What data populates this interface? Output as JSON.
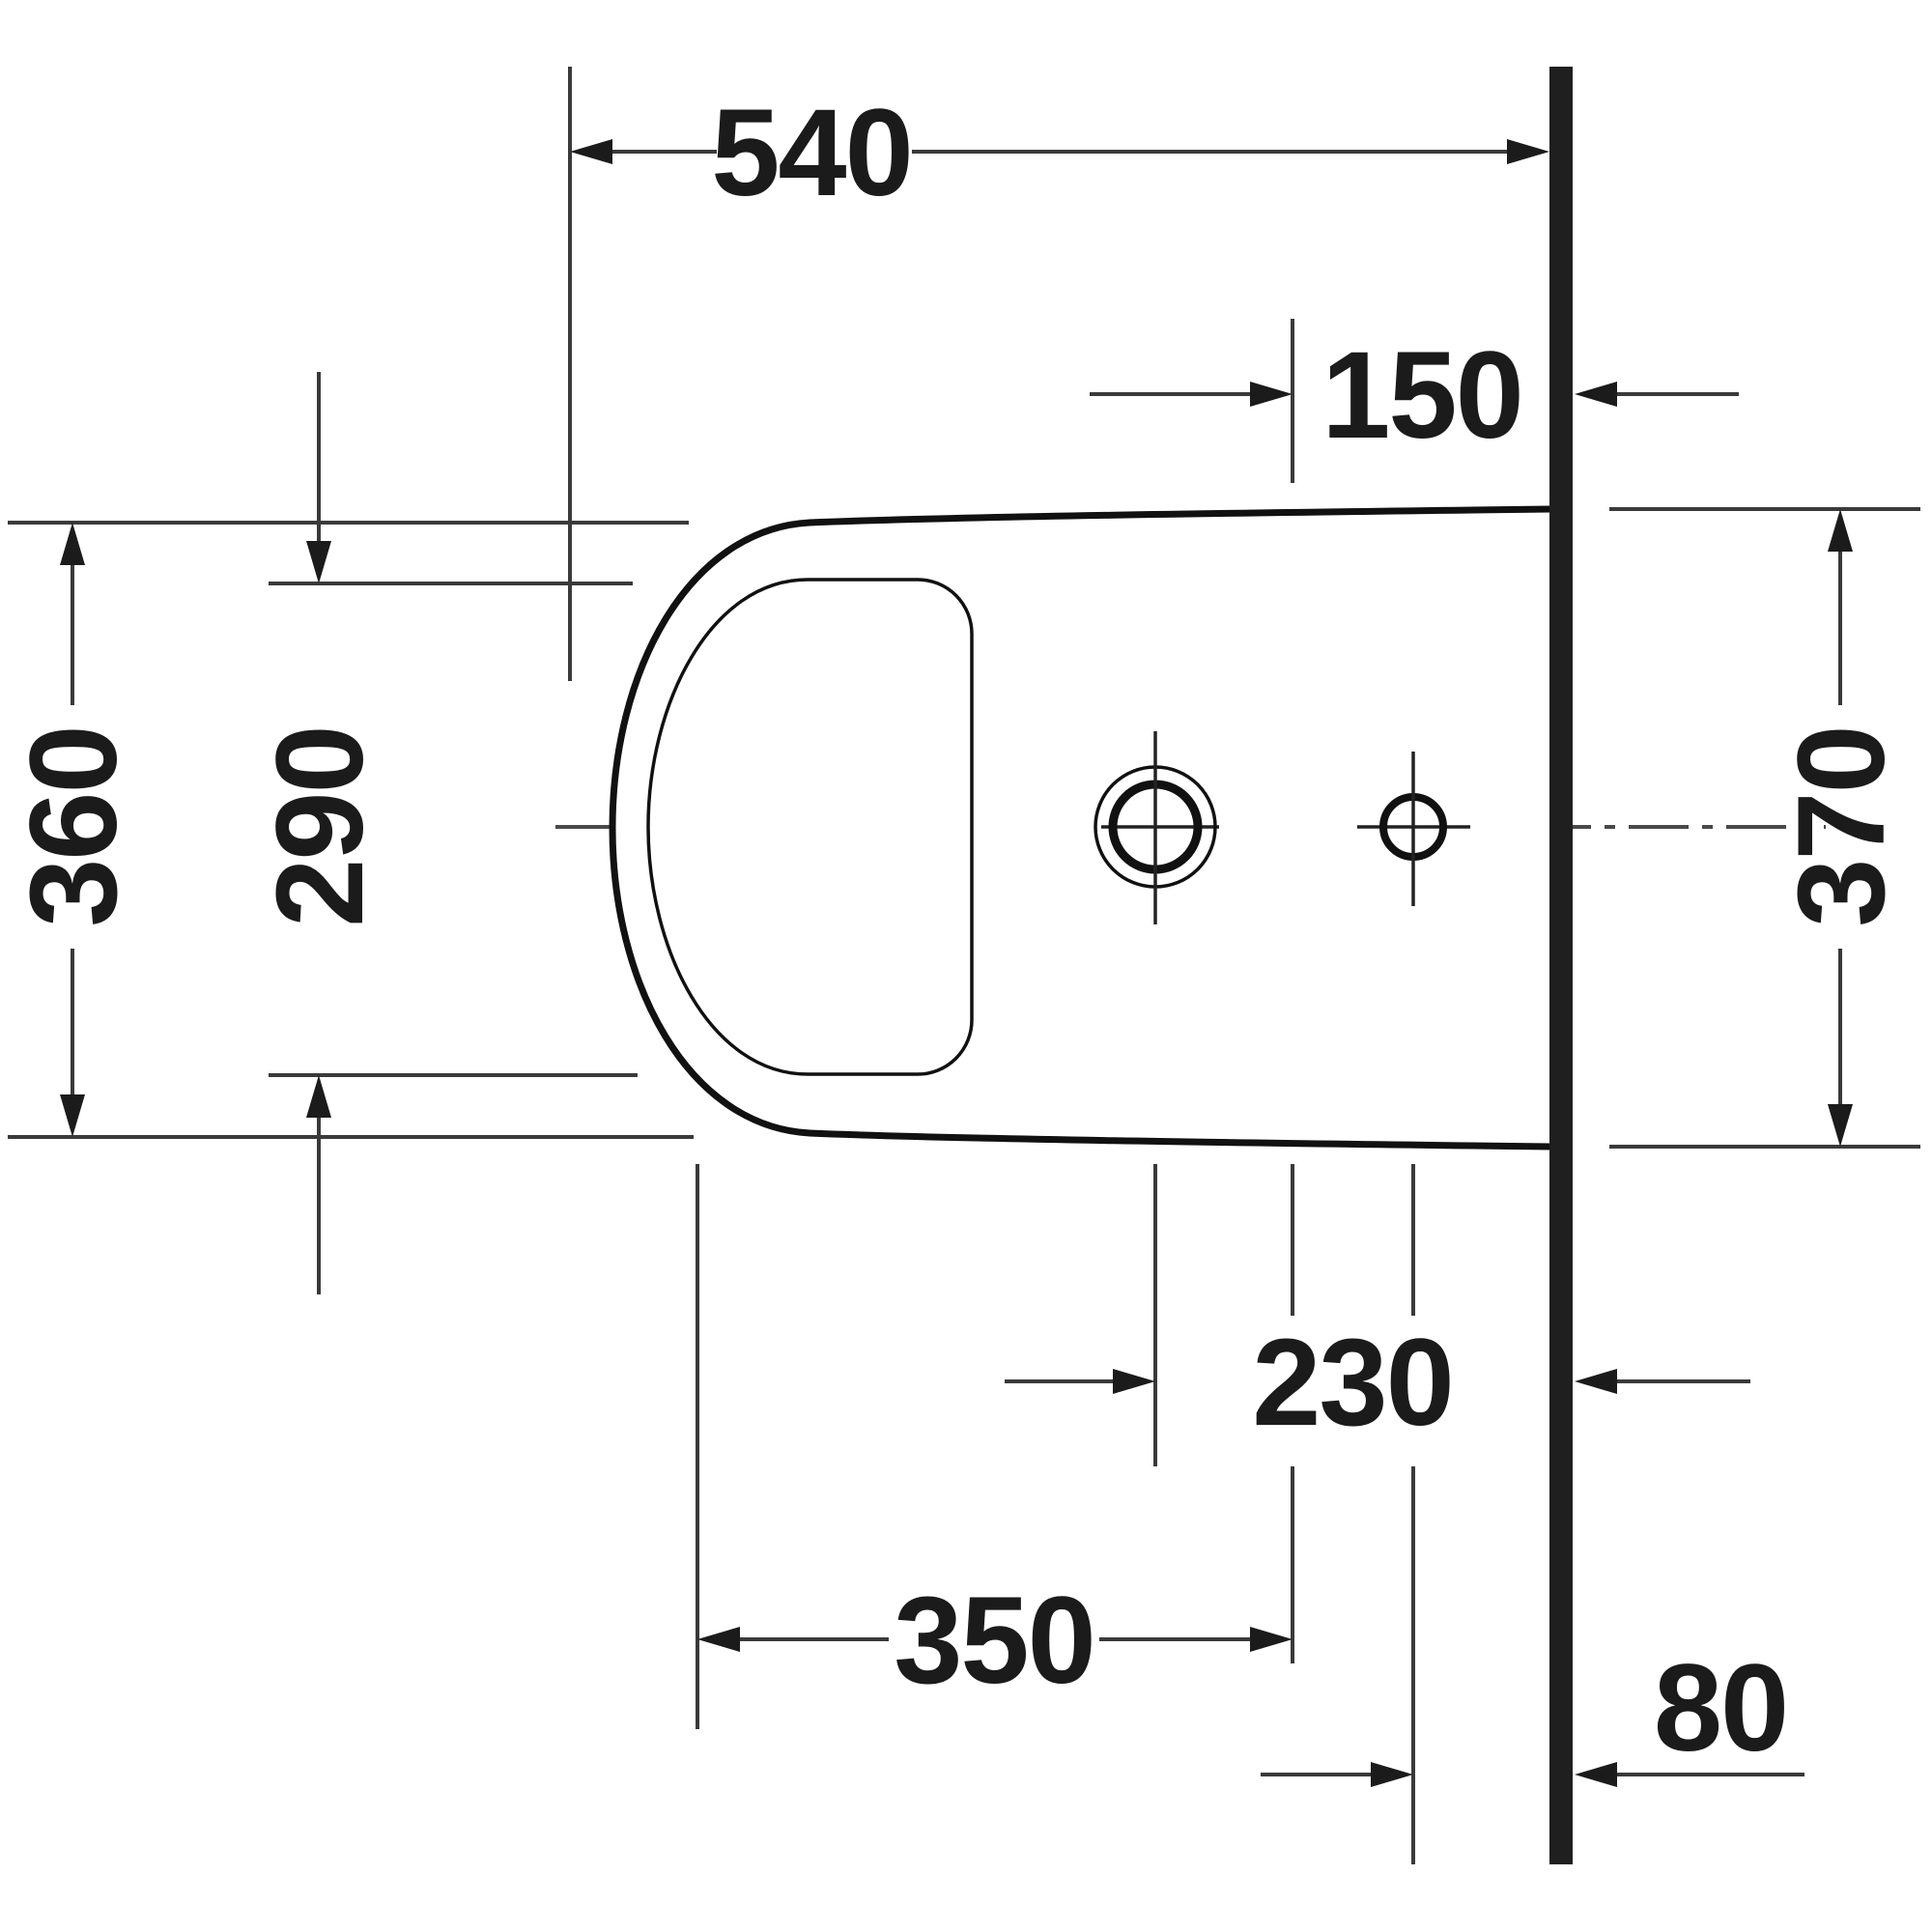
{
  "drawing": {
    "type": "technical-dimension-drawing",
    "subject": "wall-mounted bidet plan view",
    "units": "mm",
    "labels": {
      "d540": "540",
      "d150": "150",
      "d360": "360",
      "d290": "290",
      "d370": "370",
      "d230": "230",
      "d350": "350",
      "d80": "80"
    },
    "colors": {
      "background": "#ffffff",
      "outline": "#111111",
      "wall": "#1f1f1f",
      "dimension_lines": "#3a3a3a",
      "centerline": "#4a4a4a",
      "text": "#1b1b1b"
    }
  }
}
